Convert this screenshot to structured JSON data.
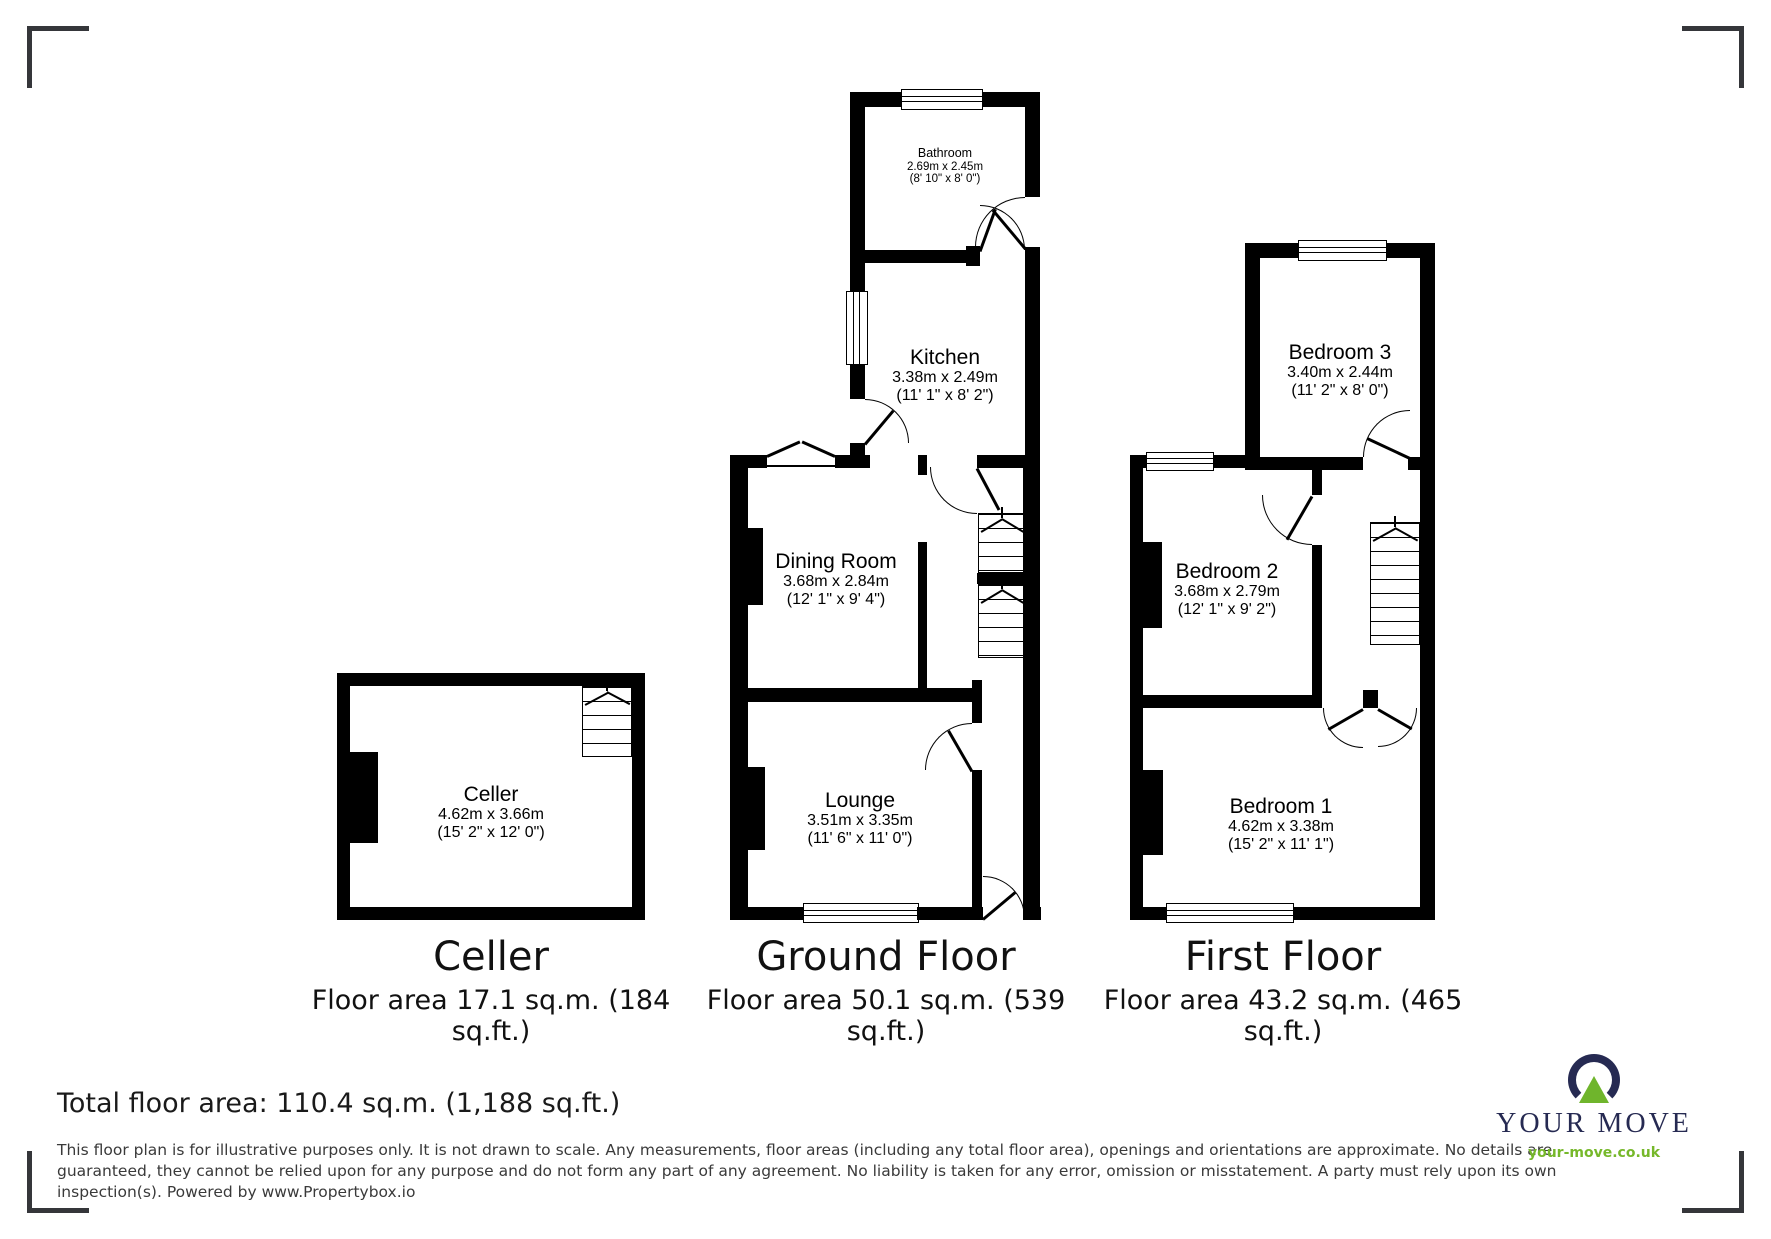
{
  "rooms": {
    "bathroom": {
      "name": "Bathroom",
      "metric": "2.69m x 2.45m",
      "imperial": "(8' 10\" x 8' 0\")"
    },
    "kitchen": {
      "name": "Kitchen",
      "metric": "3.38m x 2.49m",
      "imperial": "(11' 1\" x 8' 2\")"
    },
    "dining": {
      "name": "Dining Room",
      "metric": "3.68m x 2.84m",
      "imperial": "(12' 1\" x 9' 4\")"
    },
    "lounge": {
      "name": "Lounge",
      "metric": "3.51m x 3.35m",
      "imperial": "(11' 6\" x 11' 0\")"
    },
    "cellar": {
      "name": "Celler",
      "metric": "4.62m x 3.66m",
      "imperial": "(15' 2\" x 12' 0\")"
    },
    "bedroom3": {
      "name": "Bedroom 3",
      "metric": "3.40m x 2.44m",
      "imperial": "(11' 2\" x 8' 0\")"
    },
    "bedroom2": {
      "name": "Bedroom 2",
      "metric": "3.68m x 2.79m",
      "imperial": "(12' 1\" x 9' 2\")"
    },
    "bedroom1": {
      "name": "Bedroom 1",
      "metric": "4.62m x 3.38m",
      "imperial": "(15' 2\" x 11' 1\")"
    }
  },
  "labels": {
    "cellar": {
      "title": "Celler",
      "area1": "Floor area 17.1 sq.m. (184",
      "area2": "sq.ft.)"
    },
    "ground": {
      "title": "Ground Floor",
      "area1": "Floor area 50.1 sq.m. (539",
      "area2": "sq.ft.)"
    },
    "first": {
      "title": "First Floor",
      "area1": "Floor area 43.2 sq.m. (465",
      "area2": "sq.ft.)"
    }
  },
  "footer": {
    "total": "Total floor area: 110.4 sq.m. (1,188 sq.ft.)",
    "disc1": "This floor plan is for illustrative purposes only. It is not drawn to scale. Any measurements, floor areas (including any total floor area), openings and orientations are approximate. No details are",
    "disc2": "guaranteed, they cannot be relied upon for any purpose and do not form any part of any agreement. No liability is taken for any error, omission or misstatement. A party must rely upon its own",
    "disc3": "inspection(s). Powered by www.Propertybox.io"
  },
  "logo": {
    "brand": "YOUR MOVE",
    "url": "your-move.co.uk",
    "navy": "#262a52",
    "green": "#76b82a"
  },
  "colors": {
    "walls": "#000000",
    "corner_marks": "#35363a",
    "disclaimer_text": "#3a3a3a"
  }
}
